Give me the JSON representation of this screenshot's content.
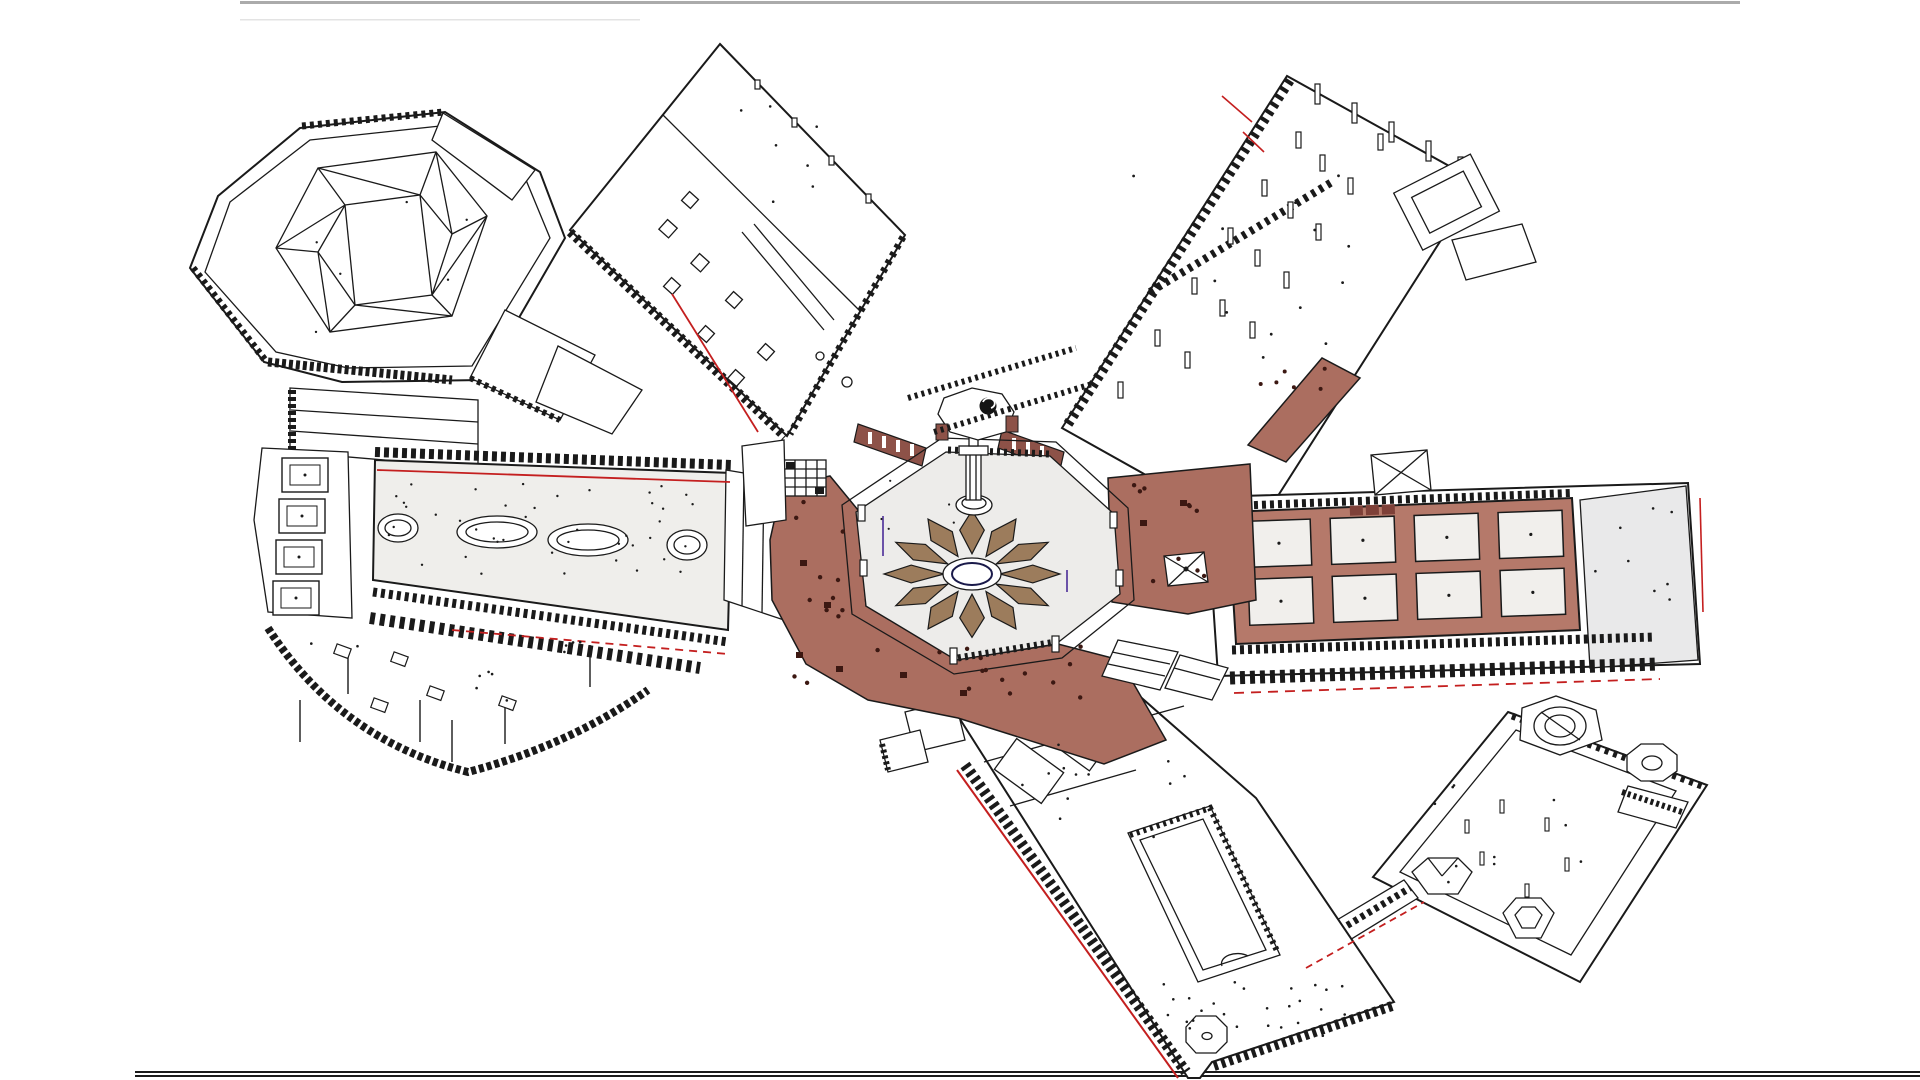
{
  "drawing": {
    "type": "isometric-architectural-site-plan",
    "background": "#ffffff",
    "line_color": "#1a1a1a",
    "colors": {
      "terracotta_floor": "#ab6e60",
      "terracotta_wall": "#8d5248",
      "terracotta_grid": "#b5796a",
      "terracotta_dark_dot": "#3c1812",
      "petal_brown": "#9c7c5c",
      "court_floor_gray": "#edecea",
      "hall_floor_gray": "#efeeeb",
      "plaza_gray": "#e9e9ea",
      "room_white": "#f1efec",
      "red_accent": "#c41f1f",
      "purple_accent": "#6b52a8",
      "navy_accent": "#1a1a4a",
      "border_gray": "#ababab"
    },
    "center_flower": {
      "petals": 12
    },
    "east_gallery_rooms": {
      "rows": 2,
      "cols": 4
    },
    "west_gallery": {
      "ovals": 2,
      "circles": 2,
      "pads": 4
    },
    "parts": [
      "hexagonal-pavilion-northwest",
      "north-gallery-wing",
      "northeast-terrace-wing",
      "east-gallery-wing",
      "southeast-courtyard-compound",
      "south-gallery-wing",
      "west-gallery-wing",
      "central-octagonal-court",
      "lotus-flower-plaza",
      "terracotta-ambulatory",
      "footbridge",
      "reflecting-pool"
    ]
  }
}
